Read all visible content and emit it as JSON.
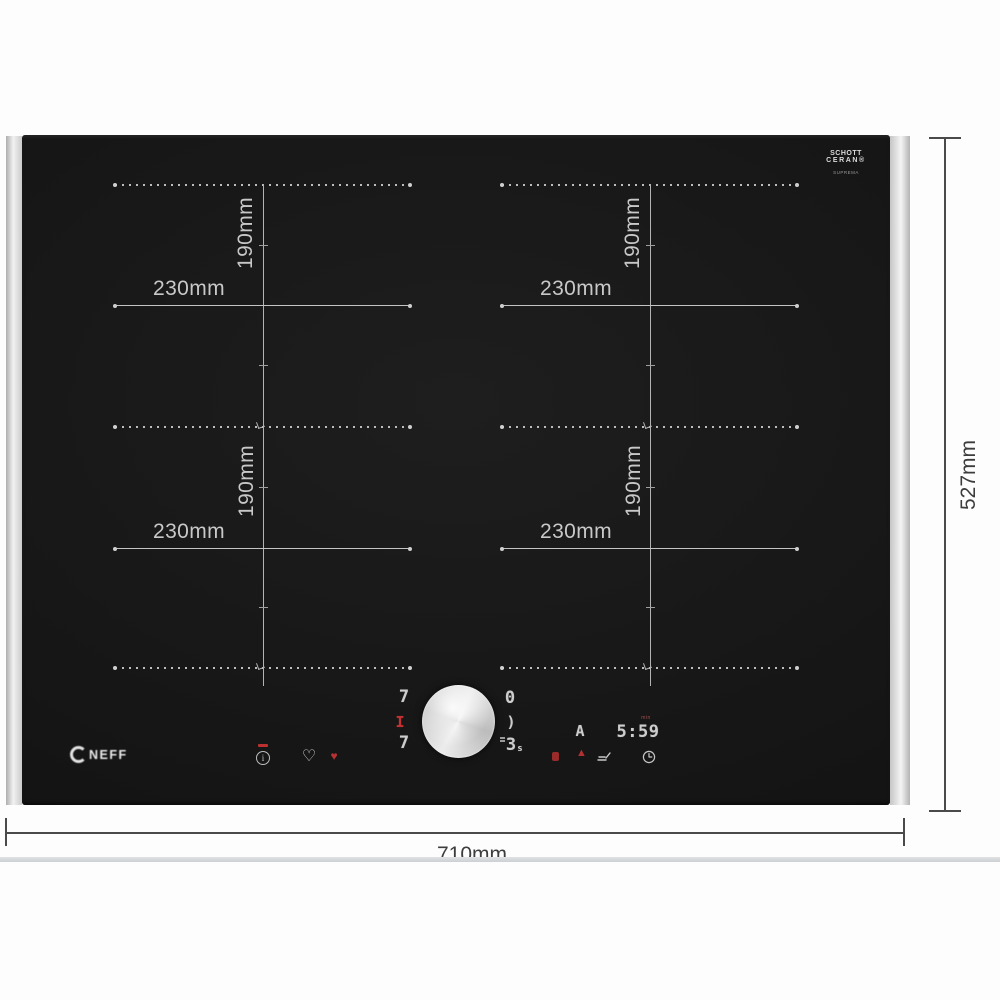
{
  "brand": {
    "logo_text": "NEFF"
  },
  "glass_branding": {
    "line1": "SCHOTT",
    "line2": "CERAN®",
    "line3": "SUPREMA"
  },
  "outer_dimensions": {
    "width": "710mm",
    "height": "527mm"
  },
  "zone_dimensions": {
    "width": "230mm",
    "height": "190mm"
  },
  "control_panel": {
    "left_display": {
      "top": "7",
      "middle": "I",
      "bottom": "7"
    },
    "right_display": {
      "top": "0",
      "middle": ")",
      "bottom": "3",
      "suffix": "s"
    },
    "auto_symbol": "A",
    "timer": {
      "value": "5:59",
      "unit": "min"
    },
    "info_symbol": "i"
  },
  "icons": {
    "favorite_outline": "♡",
    "favorite_active": "♥",
    "warning_triangle": "▲"
  },
  "colors": {
    "glass": "#161616",
    "zone_line": "#c4c4c4",
    "display_gray": "#cdcdcd",
    "accent_red": "#c23232",
    "dimension_line": "#4a4a4a"
  }
}
